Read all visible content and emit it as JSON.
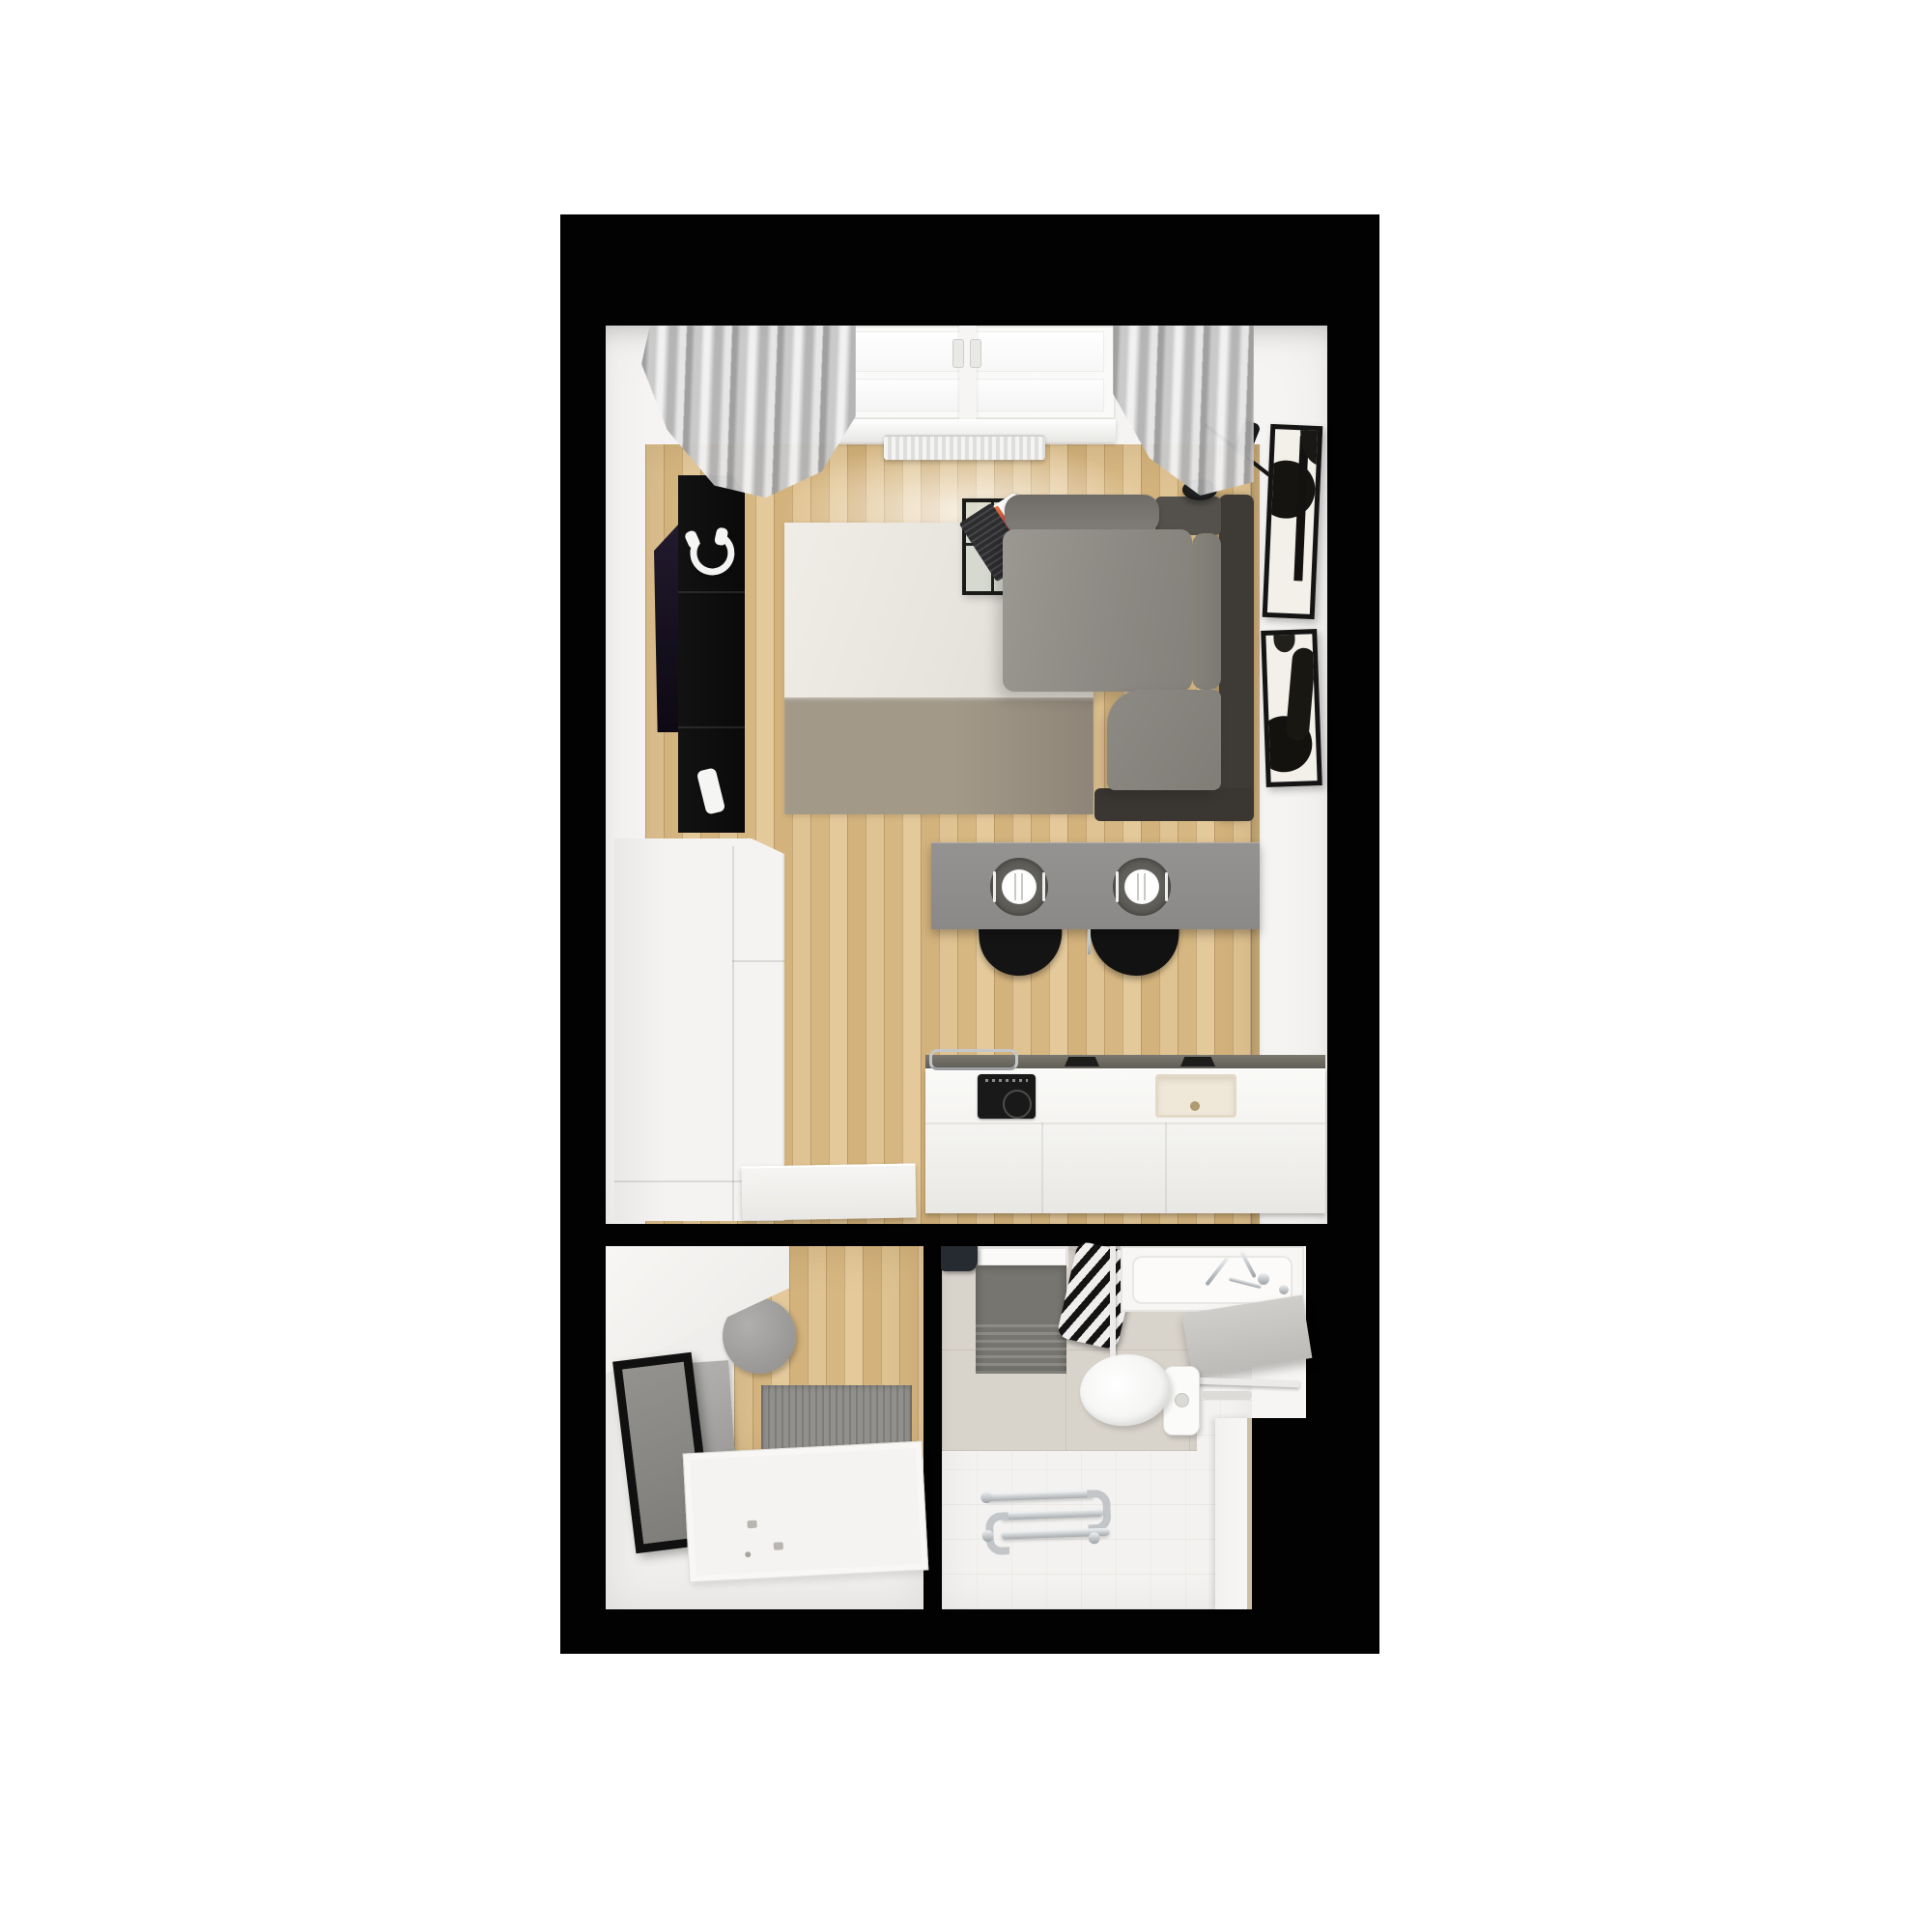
{
  "meta": {
    "kind": "3d-rendered-floor-plan-top-view",
    "apartment_type": "studio",
    "rooms": [
      "living-room-with-kitchen",
      "hallway",
      "bathroom"
    ]
  },
  "palette": {
    "page_bg": "#ffffff",
    "wall_black": "#020202",
    "room_white": "#f5f4f2",
    "floor_wood": "#dcbd8b",
    "rug_cream": "#eae7e0",
    "rug_band": "#9d9486",
    "sofa_gray": "#8e8b85",
    "sofa_dark": "#3e3b37",
    "curtain_gray": "#c7c7c7",
    "island_gray": "#8f8e8c",
    "charger_gray": "#55544f",
    "counter_white": "#f7f6f4",
    "counter_edge": "#6a675f",
    "hob_black": "#191919",
    "sink_cream": "#efe7d8",
    "sideboard_black": "#0d0d0d",
    "tv_black": "#1d1426",
    "art_paper": "#f2f0e9",
    "art_ink": "#161410",
    "bath_tile": "#d8d3cb",
    "bath_floor": "#f3f2f0",
    "mat_gray": "#76756f",
    "chrome": "#c7cacc",
    "stool_black": "#141414",
    "pouf_gray": "#a3a2a0",
    "door_white": "#f4f3f1",
    "mirror_frame": "#101010"
  },
  "scene": {
    "living_room_items": [
      "window",
      "radiator",
      "curtain-left",
      "curtain-right",
      "tv",
      "media-sideboard",
      "headphones",
      "rug",
      "coffee-table",
      "laptop",
      "corner-sofa",
      "floor-lamp",
      "wall-art-upper",
      "wall-art-lower",
      "dining-island",
      "place-setting",
      "place-setting",
      "bar-stool",
      "bar-stool",
      "tall-cabinet",
      "bench",
      "kitchen-counter",
      "induction-hob",
      "kitchen-sink",
      "utensil-rail"
    ],
    "hallway_items": [
      "wardrobe",
      "pouf",
      "leaning-mirror",
      "doormat",
      "entry-door-panel"
    ],
    "bathroom_items": [
      "shower-tray",
      "shower-fixture",
      "bath-mat",
      "striped-towel",
      "shower-rail",
      "bathtub",
      "faucet",
      "shelf",
      "toilet",
      "drain-pipe",
      "side-panel",
      "floor-grab-bars"
    ],
    "place_setting_count": 2
  }
}
